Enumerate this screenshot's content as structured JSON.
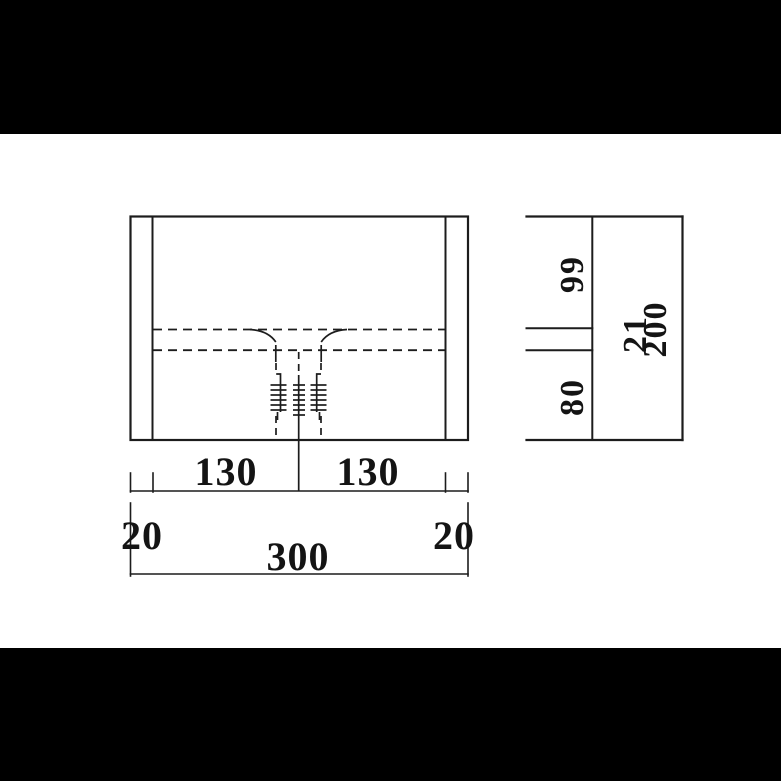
{
  "colors": {
    "letterbox": "#000000",
    "paper": "#ffffff",
    "line": "#1c1c1c"
  },
  "front_view": {
    "bottom_dims": {
      "left_shelf": "130",
      "right_shelf": "130"
    },
    "width_dims": {
      "left_panel": "20",
      "overall_width": "300",
      "right_panel": "20"
    }
  },
  "side_view": {
    "upper_section": "99",
    "lower_section": "80",
    "shelf_thickness": "21",
    "overall_height": "200"
  }
}
